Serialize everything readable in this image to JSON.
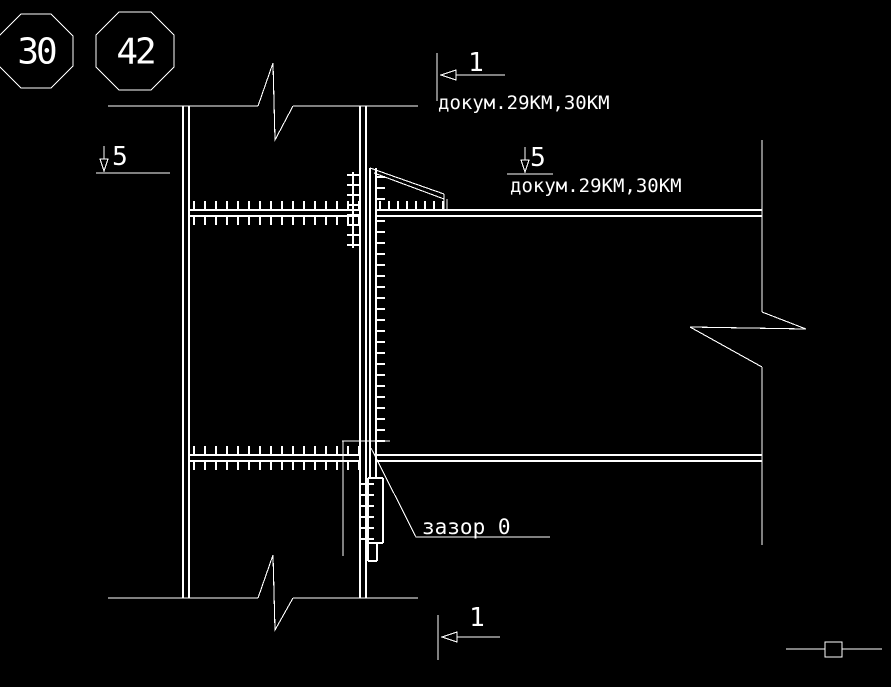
{
  "drawing": {
    "background": "#000000",
    "line_color": "#ffffff",
    "node_markers": [
      {
        "shape": "octagon",
        "label": "30"
      },
      {
        "shape": "octagon",
        "label": "42"
      }
    ],
    "section_marks": {
      "top": {
        "label": "1",
        "note": "докум.29КМ,30КМ"
      },
      "left": {
        "label": "5"
      },
      "right": {
        "label": "5",
        "note": "докум.29КМ,30КМ"
      },
      "bottom": {
        "label": "1"
      }
    },
    "annotations": {
      "gap": "зазор 0"
    }
  }
}
